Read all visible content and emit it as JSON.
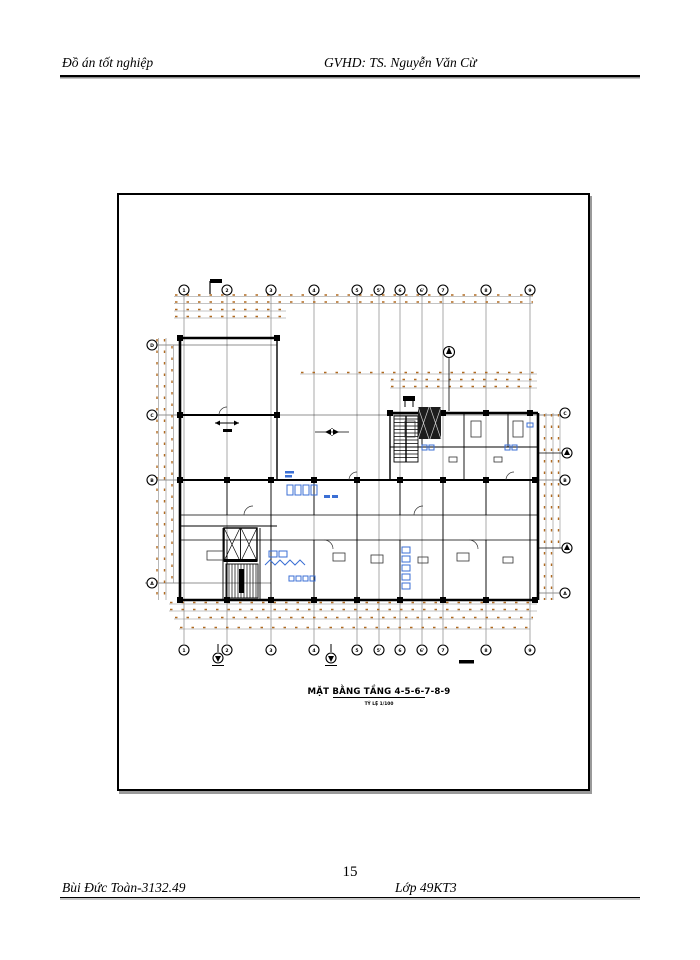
{
  "document": {
    "header": {
      "left": "Đồ án tốt nghiệp",
      "right": "GVHD: TS. Nguyễn Văn Cừ"
    },
    "footer": {
      "left": "Bùi Đức Toàn-3132.49",
      "right": "Lớp 49KT3",
      "page_number": "15"
    },
    "drawing": {
      "title": "MẶT BẰNG TẦNG 4-5-6-7-8-9",
      "subtitle": "TỶ LỆ 1/100",
      "grid_top_labels": [
        "1",
        "2",
        "3",
        "4",
        "5",
        "5'",
        "6",
        "6'",
        "7",
        "8",
        "9"
      ],
      "grid_bottom_labels": [
        "1",
        "2",
        "3",
        "4",
        "5",
        "5'",
        "6",
        "6'",
        "7",
        "8",
        "9"
      ],
      "grid_left_labels": [
        "D",
        "C",
        "B",
        "A"
      ],
      "grid_right_labels": [
        "C",
        "B",
        "A"
      ],
      "colors": {
        "wall": "#000000",
        "dimension": "#b06a20",
        "fixture": "#3b6fd4",
        "grid": "#555555"
      }
    }
  }
}
